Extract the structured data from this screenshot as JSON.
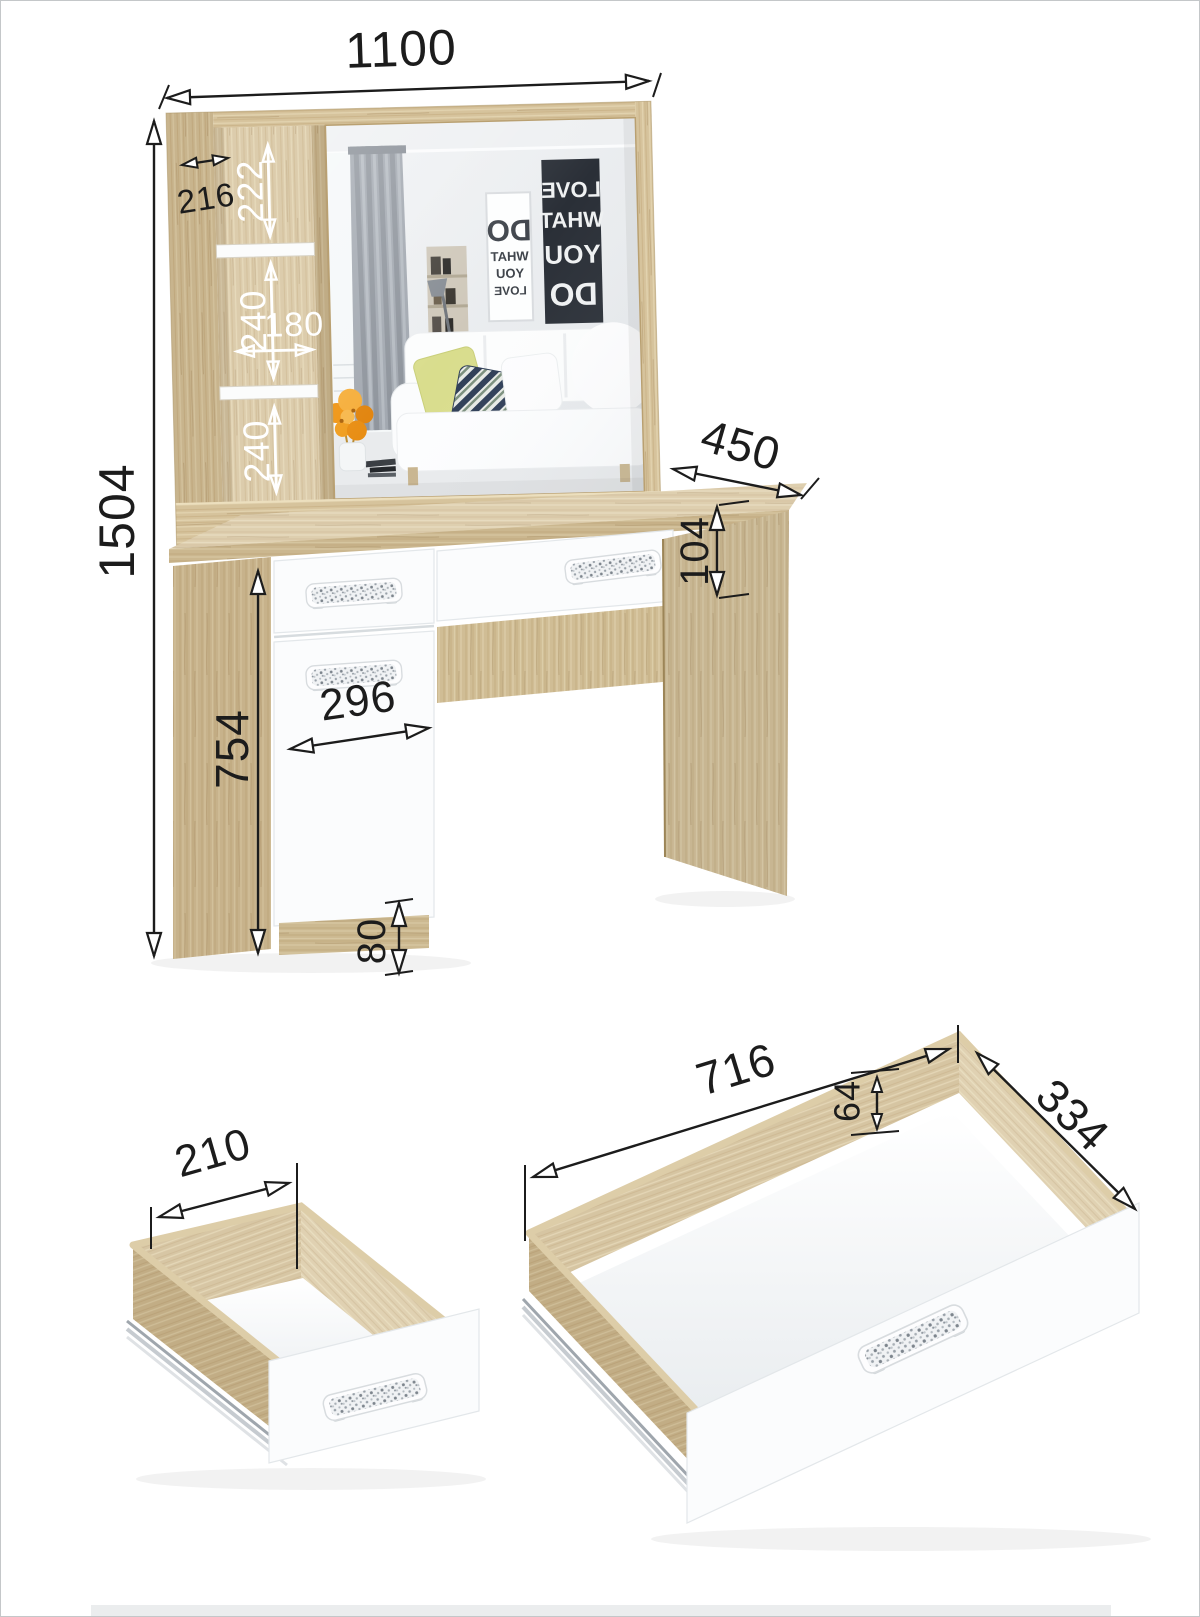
{
  "dims": {
    "overall_width": "1100",
    "overall_height": "1504",
    "shelf_depth": "216",
    "cubby_top": "222",
    "cubby_mid": "240",
    "cubby_width": "180",
    "cubby_bottom": "240",
    "desktop_depth": "450",
    "drawer_front_height": "104",
    "door_width": "296",
    "pedestal_height": "754",
    "plinth_height": "80",
    "small_drawer_width": "210",
    "big_drawer_width": "716",
    "big_drawer_depth": "334",
    "big_drawer_side_height": "64"
  },
  "mirror": {
    "poster_light_lines": [
      "DO",
      "WHAT",
      "YOU",
      "LOVE"
    ],
    "poster_dark_lines": [
      "LOVE",
      "WHAT",
      "YOU",
      "DO"
    ]
  },
  "colors": {
    "wood": "#d6c39c",
    "wood_dark": "#c2aa7e",
    "wood_light": "#e6d8b6",
    "front_white": "#fbfcfd",
    "dim_line": "#1c1c1c",
    "dim_white": "#ffffff",
    "curtain_gray": "#a2a8b0",
    "pillow_yellow": "#d9dd8d",
    "pillow_navy": "#2f3e57",
    "flowers_orange": "#ef9412",
    "handle_speckle": "#8b939c"
  }
}
